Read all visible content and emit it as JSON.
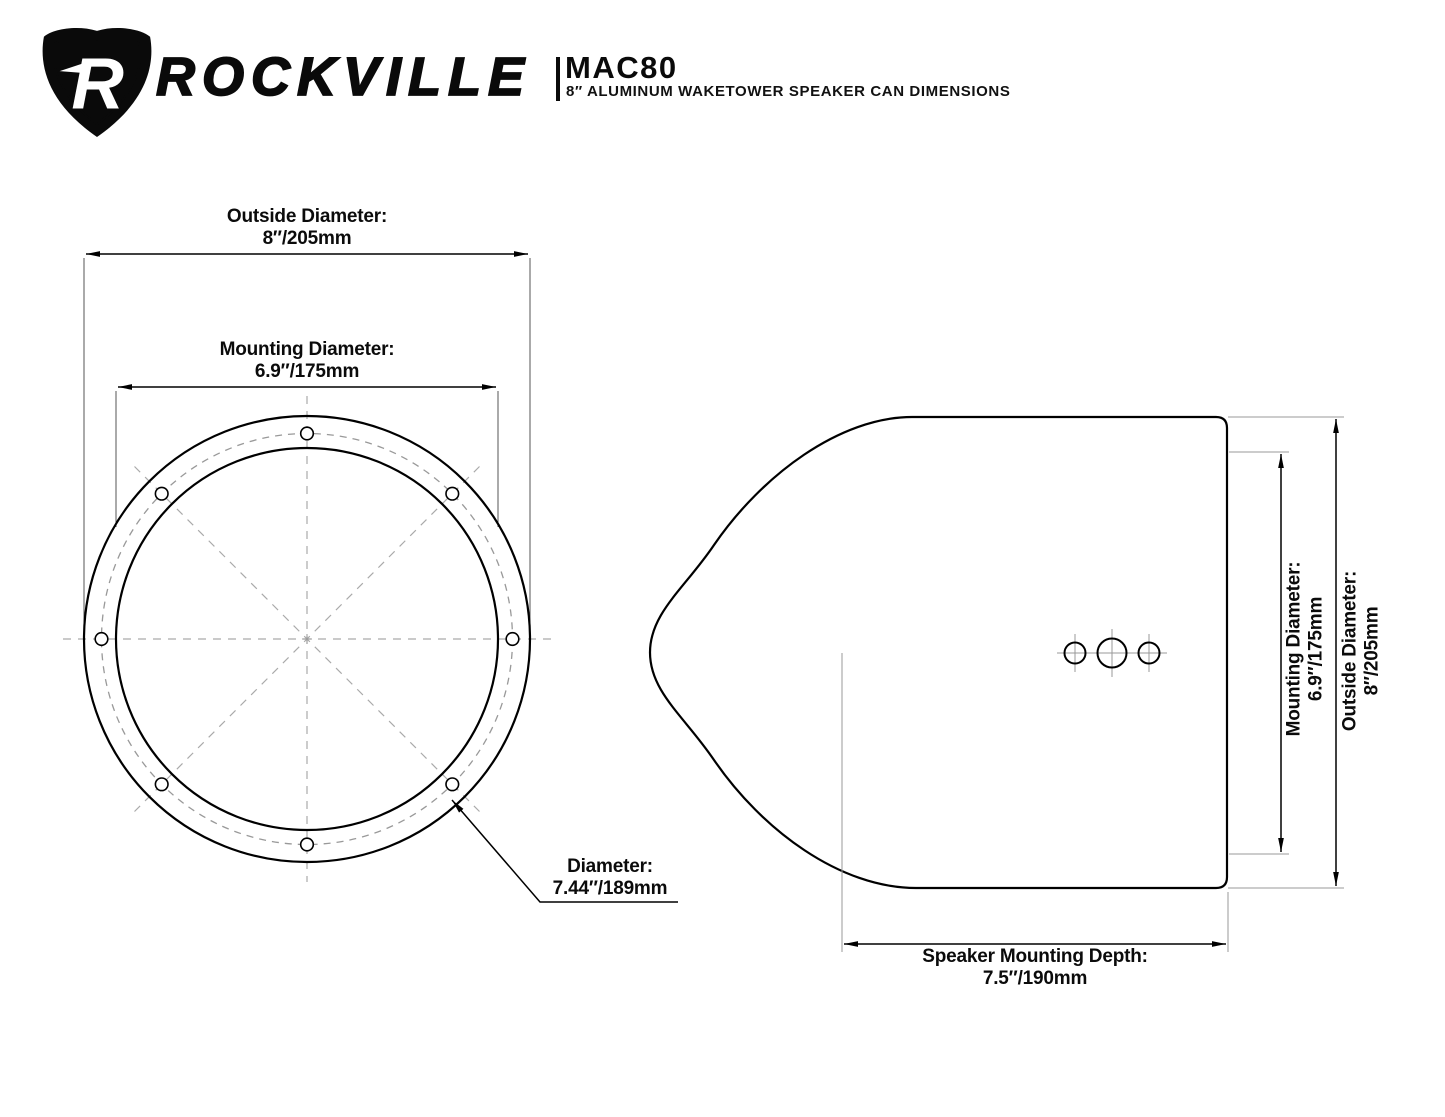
{
  "header": {
    "brand": "ROCKVILLE",
    "logo_letter": "R",
    "model": "MAC80",
    "subtitle": "8″ ALUMINUM WAKETOWER SPEAKER CAN DIMENSIONS"
  },
  "front_view": {
    "title": "speaker can front view",
    "outside_diameter_label": "Outside Diameter:",
    "outside_diameter_value": "8″/205mm",
    "mounting_diameter_label": "Mounting Diameter:",
    "mounting_diameter_value": "6.9″/175mm",
    "bolt_circle_label": "Diameter:",
    "bolt_circle_value": "7.44″/189mm",
    "bolt_hole_count": 8
  },
  "side_view": {
    "title": "speaker can side view",
    "mounting_diameter_label": "Mounting Diameter:",
    "mounting_diameter_value": "6.9″/175mm",
    "outside_diameter_label": "Outside Diameter:",
    "outside_diameter_value": "8″/205mm",
    "mounting_depth_label": "Speaker Mounting Depth:",
    "mounting_depth_value": "7.5″/190mm",
    "rear_hole_count": 3
  },
  "colors": {
    "line": "#000000",
    "extension_line": "#555555",
    "aux_line": "#999999",
    "centerline": "#aaaaaa",
    "background": "#ffffff",
    "text": "#0b0b0b"
  }
}
